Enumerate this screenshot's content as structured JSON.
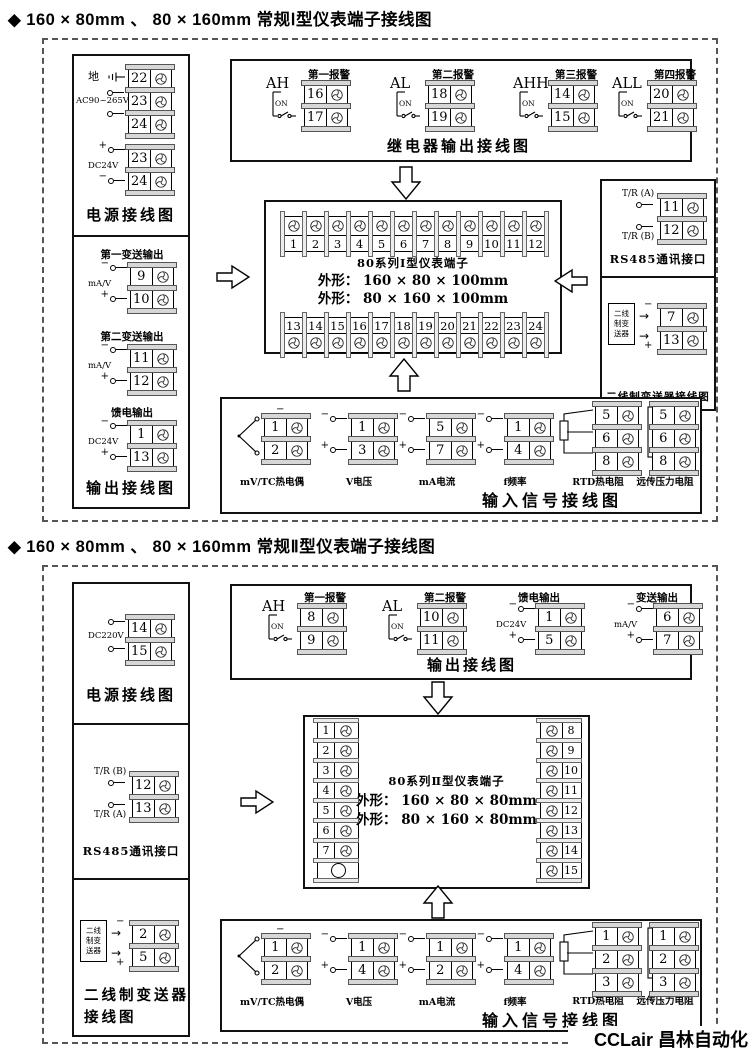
{
  "signs": {
    "plus": "+",
    "minus": "−"
  },
  "watermark": "CCLair 昌林自动化",
  "s1": {
    "title": "◆ 160 × 80mm 、 80 × 160mm 常规Ⅰ型仪表端子接线图",
    "power": {
      "ground": "地",
      "ac": "AC90~265V",
      "ac_terms": [
        "22",
        "23",
        "24"
      ],
      "dc": "DC24V",
      "dc_terms": [
        "23",
        "24"
      ],
      "label": "电源接线图"
    },
    "out": {
      "g1_title": "第一变送输出",
      "g1_sig": "mA/V",
      "g1_terms": [
        "9",
        "10"
      ],
      "g2_title": "第二变送输出",
      "g2_sig": "mA/V",
      "g2_terms": [
        "11",
        "12"
      ],
      "g3_title": "馈电输出",
      "g3_sig": "DC24V",
      "g3_terms": [
        "1",
        "13"
      ],
      "label": "输出接线图"
    },
    "relay": {
      "label": "继电器输出接线图",
      "a1": {
        "name": "AH",
        "title": "第一报警",
        "sw": "ON",
        "terms": [
          "16",
          "17"
        ]
      },
      "a2": {
        "name": "AL",
        "title": "第二报警",
        "sw": "ON",
        "terms": [
          "18",
          "19"
        ]
      },
      "a3": {
        "name": "AHH",
        "title": "第三报警",
        "sw": "ON",
        "terms": [
          "14",
          "15"
        ]
      },
      "a4": {
        "name": "ALL",
        "title": "第四报警",
        "sw": "ON",
        "terms": [
          "20",
          "21"
        ]
      }
    },
    "center": {
      "top_terms": [
        "1",
        "2",
        "3",
        "4",
        "5",
        "6",
        "7",
        "8",
        "9",
        "10",
        "11",
        "12"
      ],
      "bottom_terms": [
        "13",
        "14",
        "15",
        "16",
        "17",
        "18",
        "19",
        "20",
        "21",
        "22",
        "23",
        "24"
      ],
      "title": "80系列Ⅰ型仪表端子",
      "dim1": "外形： 160 × 80 × 100mm",
      "dim2": "外形： 80 × 160 × 100mm"
    },
    "rs485": {
      "a": "T/R (A)",
      "b": "T/R (B)",
      "terms": [
        "11",
        "12"
      ],
      "label": "RS485通讯接口"
    },
    "twowire": {
      "dev": [
        "二线",
        "制变",
        "送器"
      ],
      "terms": [
        "7",
        "13"
      ],
      "label": "二线制变送器接线图"
    },
    "input": {
      "label": "输入信号接线图",
      "tc": {
        "name": "mV/TC热电偶",
        "terms": [
          "1",
          "2"
        ]
      },
      "v": {
        "name": "V电压",
        "terms": [
          "1",
          "3"
        ]
      },
      "ma": {
        "name": "mA电流",
        "terms": [
          "5",
          "7"
        ]
      },
      "f": {
        "name": "f频率",
        "terms": [
          "1",
          "4"
        ]
      },
      "rtd": {
        "name": "RTD热电阻",
        "terms": [
          "5",
          "6",
          "8"
        ]
      },
      "res": {
        "name": "远传压力电阻",
        "terms": [
          "5",
          "6",
          "8"
        ]
      }
    }
  },
  "s2": {
    "title": "◆ 160 × 80mm 、 80 × 160mm 常规Ⅱ型仪表端子接线图",
    "power": {
      "src": "DC220V",
      "terms": [
        "14",
        "15"
      ],
      "label": "电源接线图"
    },
    "rs485": {
      "b": "T/R (B)",
      "a": "T/R (A)",
      "terms": [
        "12",
        "13"
      ],
      "label": "RS485通讯接口"
    },
    "twowire": {
      "dev": [
        "二线",
        "制变",
        "送器"
      ],
      "terms": [
        "2",
        "5"
      ],
      "label1": "二线制变送器",
      "label2": "接线图"
    },
    "out": {
      "label": "输出接线图",
      "a1": {
        "name": "AH",
        "title": "第一报警",
        "sw": "ON",
        "terms": [
          "8",
          "9"
        ]
      },
      "a2": {
        "name": "AL",
        "title": "第二报警",
        "sw": "ON",
        "terms": [
          "10",
          "11"
        ]
      },
      "feed": {
        "title": "馈电输出",
        "sig": "DC24V",
        "terms": [
          "1",
          "5"
        ]
      },
      "tx": {
        "title": "变送输出",
        "sig": "mA/V",
        "terms": [
          "6",
          "7"
        ]
      }
    },
    "center": {
      "left_terms": [
        "1",
        "2",
        "3",
        "4",
        "5",
        "6",
        "7"
      ],
      "right_terms": [
        "8",
        "9",
        "10",
        "11",
        "12",
        "13",
        "14",
        "15"
      ],
      "title": "80系列Ⅱ型仪表端子",
      "dim1": "外形： 160 × 80 × 80mm",
      "dim2": "外形： 80 × 160 × 80mm"
    },
    "input": {
      "label": "输入信号接线图",
      "tc": {
        "name": "mV/TC热电偶",
        "terms": [
          "1",
          "2"
        ]
      },
      "v": {
        "name": "V电压",
        "terms": [
          "1",
          "4"
        ]
      },
      "ma": {
        "name": "mA电流",
        "terms": [
          "1",
          "2"
        ]
      },
      "f": {
        "name": "f频率",
        "terms": [
          "1",
          "4"
        ]
      },
      "rtd": {
        "name": "RTD热电阻",
        "terms": [
          "1",
          "2",
          "3"
        ]
      },
      "res": {
        "name": "远传压力电阻",
        "terms": [
          "1",
          "2",
          "3"
        ]
      }
    }
  }
}
